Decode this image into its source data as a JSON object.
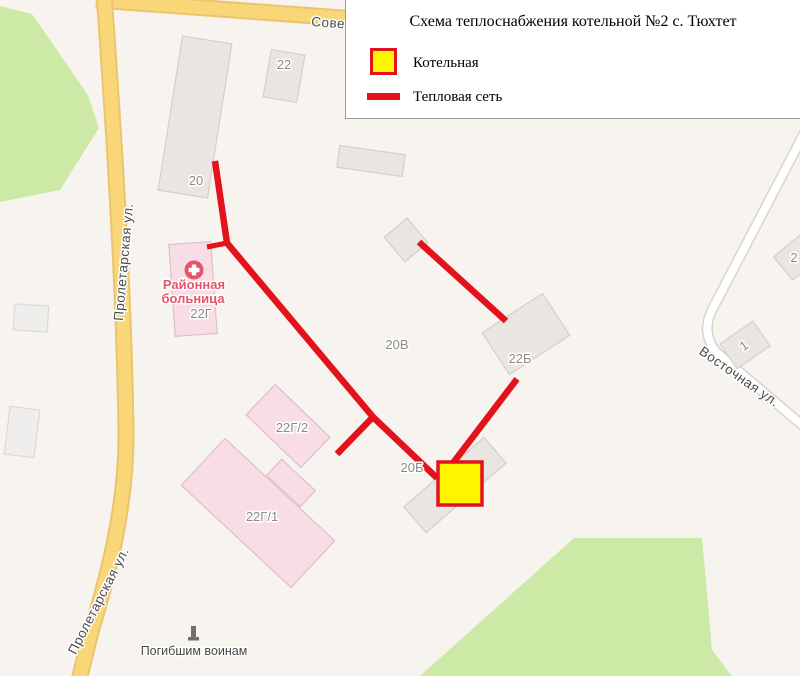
{
  "legend": {
    "title": "Схема теплоснабжения котельной №2 с. Тюхтет",
    "items": {
      "boiler": {
        "label": "Котельная"
      },
      "network": {
        "label": "Тепловая сеть"
      }
    }
  },
  "streets": {
    "sovetskaya": "Советская",
    "proletarskaya_top": "Пролетарская ул.",
    "proletarskaya_bottom": "Пролетарская ул.",
    "vostochnaya": "Восточная ул."
  },
  "buildings": {
    "b20": "20",
    "b22": "22",
    "b22g": "22Г",
    "b22g2": "22Г/2",
    "b22g1": "22Г/1",
    "b20v": "20В",
    "b20b": "20Б",
    "b22b": "22Б",
    "b1": "1",
    "b2": "2"
  },
  "poi": {
    "hospital_line1": "Районная",
    "hospital_line2": "больница",
    "memorial": "Погибшим воинам"
  },
  "colors": {
    "heat_network": "#e3131c",
    "boiler_fill": "#fff500",
    "boiler_border": "#e3131c",
    "road_fill": "#f9d678",
    "road_casing": "#ecc46d",
    "park_fill": "#cde9a6",
    "building_gray": "#e9e5e0",
    "building_pink": "#f8dde6",
    "hospital_poi": "#e2556b",
    "map_background": "#f7f4ef"
  }
}
